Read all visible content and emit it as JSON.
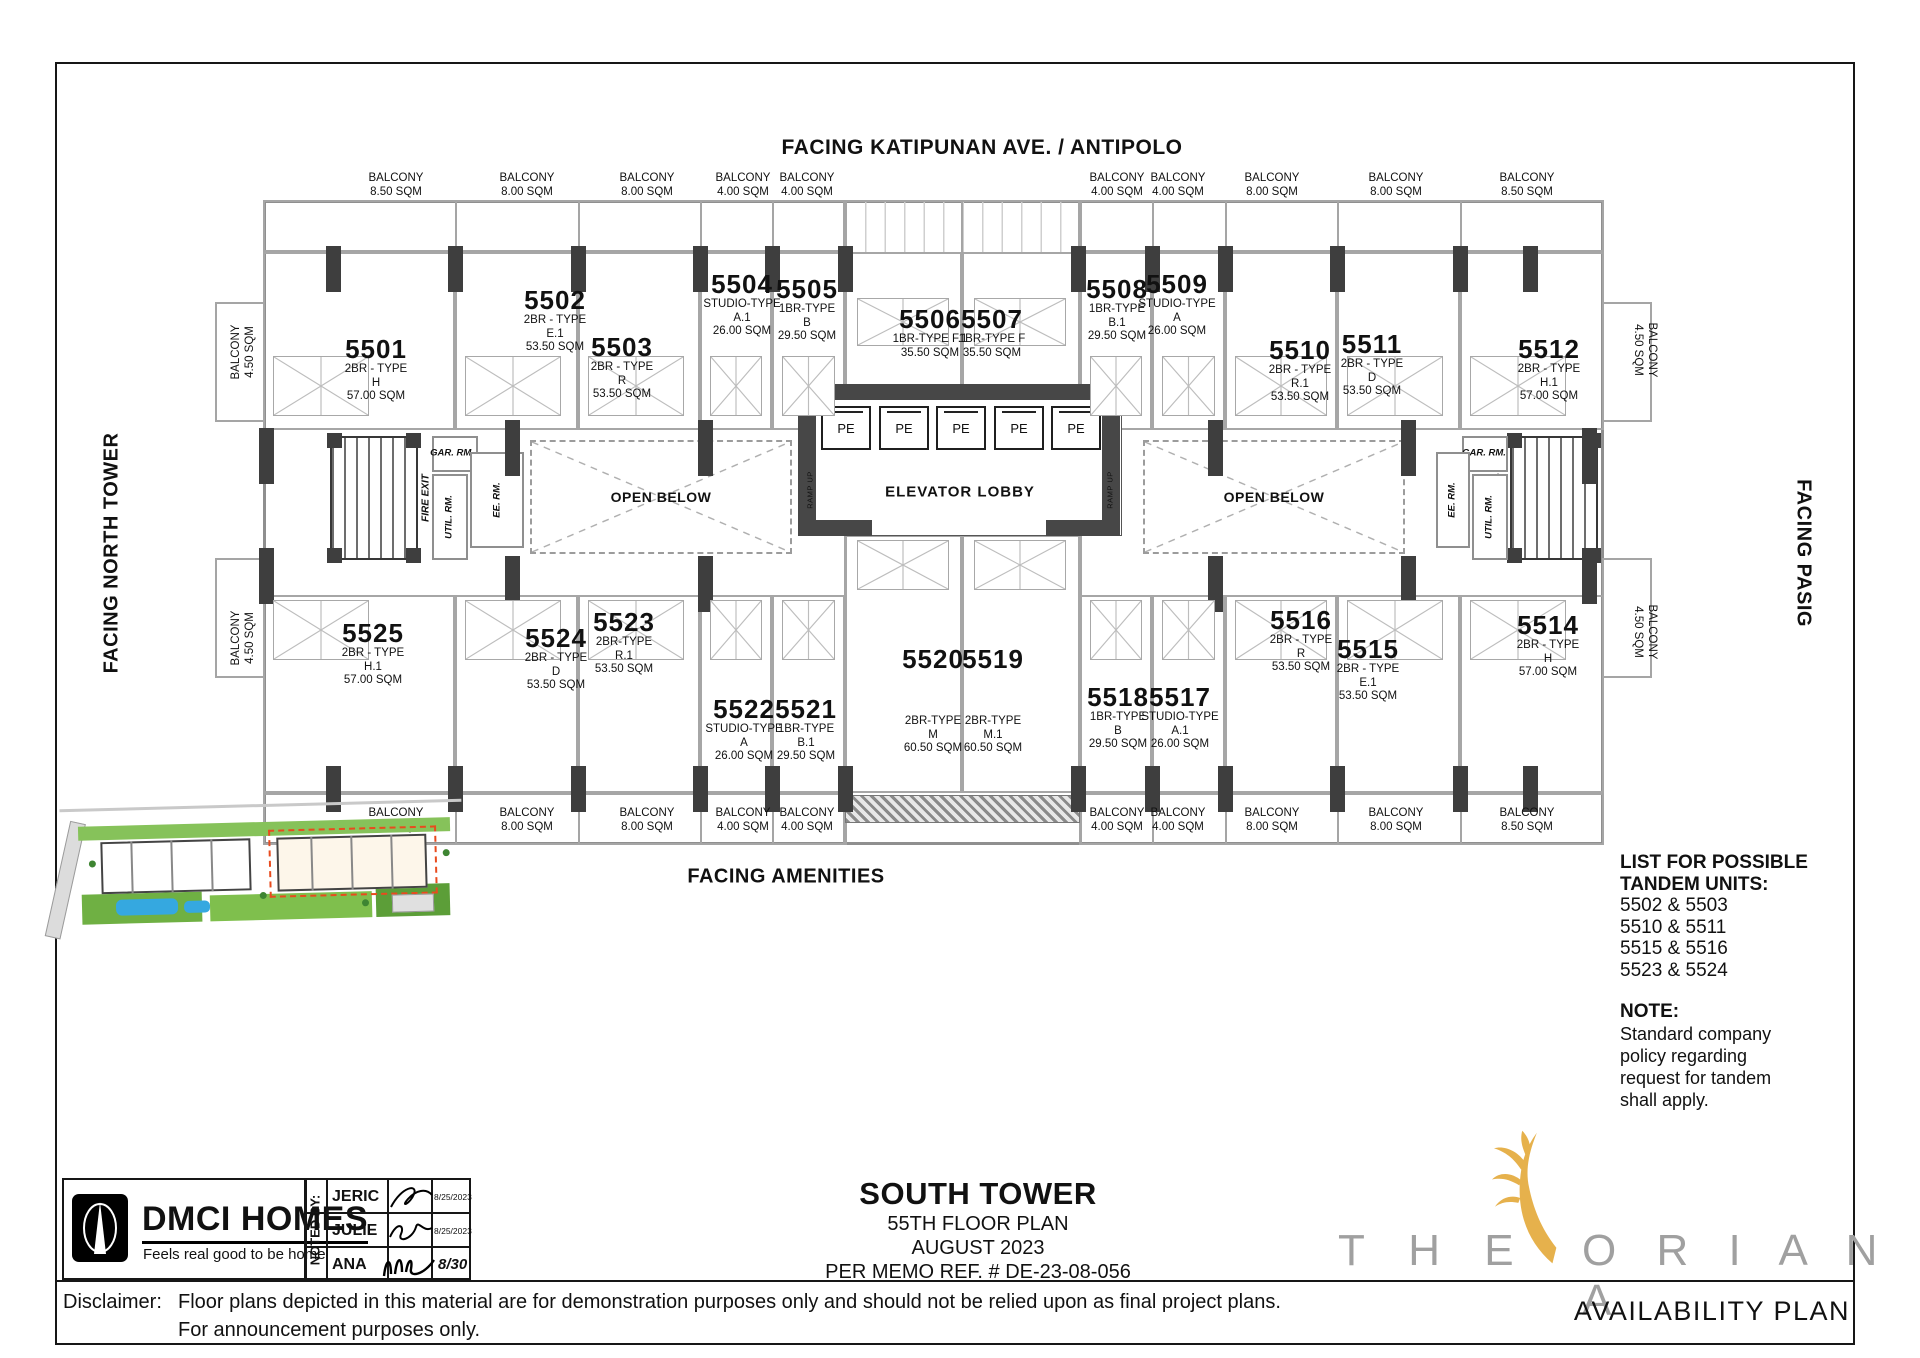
{
  "sheet": {
    "availability_label": "AVAILABILITY PLAN"
  },
  "facing": {
    "top": "FACING KATIPUNAN AVE. / ANTIPOLO",
    "bottom": "FACING AMENITIES",
    "left": "FACING NORTH TOWER",
    "right": "FACING PASIG"
  },
  "plan": {
    "balcony_word": "BALCONY",
    "top_balconies": [
      "8.50 SQM",
      "8.00 SQM",
      "8.00 SQM",
      "4.00 SQM",
      "4.00 SQM",
      "4.00 SQM",
      "4.00 SQM",
      "8.00 SQM",
      "8.00 SQM",
      "8.50 SQM"
    ],
    "bottom_balconies": [
      "8.50 SQM",
      "8.00 SQM",
      "8.00 SQM",
      "4.00 SQM",
      "4.00 SQM",
      "4.00 SQM",
      "4.00 SQM",
      "8.00 SQM",
      "8.00 SQM",
      "8.50 SQM"
    ],
    "side_balconies": [
      "4.50 SQM",
      "4.50 SQM",
      "4.50 SQM",
      "4.50 SQM"
    ],
    "elevator_lobby": "ELEVATOR LOBBY",
    "elevator_car": "PE",
    "open_below": "OPEN BELOW",
    "ramp_up": "RAMP UP",
    "fire_exit": "FIRE EXIT",
    "garbage_room": "GAR. RM.",
    "utility_room": "UTIL. RM.",
    "electrical_room": "EE. RM.",
    "units": [
      {
        "no": "5501",
        "type_lines": [
          "2BR - TYPE",
          "H"
        ],
        "area": "57.00 SQM"
      },
      {
        "no": "5502",
        "type_lines": [
          "2BR - TYPE",
          "E.1"
        ],
        "area": "53.50 SQM"
      },
      {
        "no": "5503",
        "type_lines": [
          "2BR - TYPE",
          "R"
        ],
        "area": "53.50 SQM"
      },
      {
        "no": "5504",
        "type_lines": [
          "STUDIO-TYPE",
          "A.1"
        ],
        "area": "26.00 SQM"
      },
      {
        "no": "5505",
        "type_lines": [
          "1BR-TYPE",
          "B"
        ],
        "area": "29.50 SQM"
      },
      {
        "no": "5506",
        "type_lines": [
          "1BR-TYPE F.1"
        ],
        "area": "35.50 SQM"
      },
      {
        "no": "5507",
        "type_lines": [
          "1BR-TYPE F"
        ],
        "area": "35.50 SQM"
      },
      {
        "no": "5508",
        "type_lines": [
          "1BR-TYPE",
          "B.1"
        ],
        "area": "29.50 SQM"
      },
      {
        "no": "5509",
        "type_lines": [
          "STUDIO-TYPE",
          "A"
        ],
        "area": "26.00 SQM"
      },
      {
        "no": "5510",
        "type_lines": [
          "2BR - TYPE",
          "R.1"
        ],
        "area": "53.50 SQM"
      },
      {
        "no": "5511",
        "type_lines": [
          "2BR - TYPE",
          "D"
        ],
        "area": "53.50 SQM"
      },
      {
        "no": "5512",
        "type_lines": [
          "2BR - TYPE",
          "H.1"
        ],
        "area": "57.00 SQM"
      },
      {
        "no": "5514",
        "type_lines": [
          "2BR - TYPE",
          "H"
        ],
        "area": "57.00 SQM"
      },
      {
        "no": "5515",
        "type_lines": [
          "2BR - TYPE",
          "E.1"
        ],
        "area": "53.50 SQM"
      },
      {
        "no": "5516",
        "type_lines": [
          "2BR - TYPE",
          "R"
        ],
        "area": "53.50 SQM"
      },
      {
        "no": "5517",
        "type_lines": [
          "STUDIO-TYPE",
          "A.1"
        ],
        "area": "26.00 SQM"
      },
      {
        "no": "5518",
        "type_lines": [
          "1BR-TYPE",
          "B"
        ],
        "area": "29.50 SQM"
      },
      {
        "no": "5519",
        "type_lines": [
          "2BR-TYPE",
          "M.1"
        ],
        "area": "60.50 SQM"
      },
      {
        "no": "5520",
        "type_lines": [
          "2BR-TYPE",
          "M"
        ],
        "area": "60.50 SQM"
      },
      {
        "no": "5521",
        "type_lines": [
          "1BR-TYPE",
          "B.1"
        ],
        "area": "29.50 SQM"
      },
      {
        "no": "5522",
        "type_lines": [
          "STUDIO-TYPE",
          "A"
        ],
        "area": "26.00 SQM"
      },
      {
        "no": "5523",
        "type_lines": [
          "2BR-TYPE",
          "R.1"
        ],
        "area": "53.50 SQM"
      },
      {
        "no": "5524",
        "type_lines": [
          "2BR - TYPE",
          "D"
        ],
        "area": "53.50 SQM"
      },
      {
        "no": "5525",
        "type_lines": [
          "2BR - TYPE",
          "H.1"
        ],
        "area": "57.00 SQM"
      }
    ]
  },
  "tandem": {
    "heading1": "LIST FOR POSSIBLE",
    "heading2": "TANDEM UNITS:",
    "pairs": [
      "5502 & 5503",
      "5510 & 5511",
      "5515 & 5516",
      "5523 & 5524"
    ],
    "note_heading": "NOTE:",
    "note_lines": [
      "Standard company",
      "policy regarding",
      "request for tandem",
      "shall apply."
    ]
  },
  "title_block": {
    "tower": "SOUTH TOWER",
    "floor": "55TH FLOOR PLAN",
    "month": "AUGUST 2023",
    "memo": "PER MEMO REF. # DE-23-08-056"
  },
  "dmci": {
    "name": "DMCI HOMES",
    "tagline": "Feels real good to be home"
  },
  "noted_by": {
    "label": "NOTED BY:",
    "rows": [
      {
        "name": "JERIC",
        "date": "8/25/2023"
      },
      {
        "name": "JULIE",
        "date": "8/25/2023"
      },
      {
        "name": "ANA",
        "date": "8/30"
      }
    ]
  },
  "disclaimer": {
    "label": "Disclaimer:",
    "line1": "Floor plans depicted in this material are for demonstration purposes only and should not be relied upon as final project plans.",
    "line2": "For announcement purposes only."
  },
  "brand": {
    "word1": "T H E",
    "word2": "O R I A N A"
  }
}
